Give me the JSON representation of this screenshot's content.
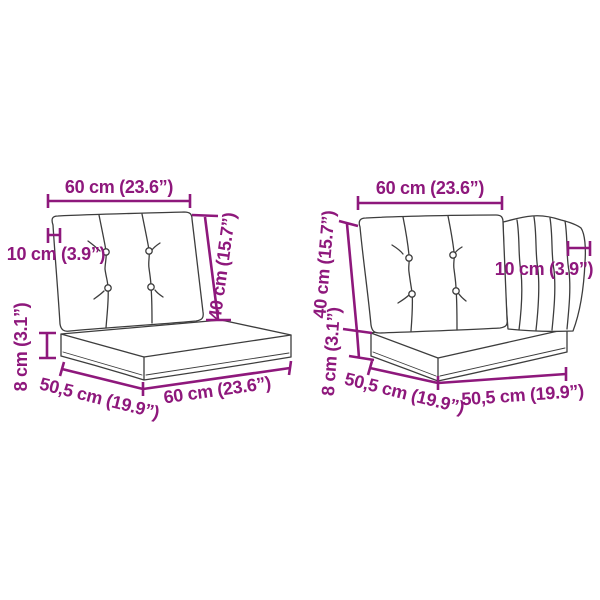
{
  "diagram": {
    "background_color": "#ffffff",
    "dimension_color": "#8E187C",
    "sketch_color": "#3d3d3d",
    "figure_left": {
      "labels": {
        "top_width": "60 cm (23.6”)",
        "back_cushion_thickness": "10 cm (3.9”)",
        "back_cushion_height": "40 cm (15.7”)",
        "seat_cushion_thickness": "8 cm (3.1”)",
        "seat_depth": "50,5 cm (19.9”)",
        "seat_width": "60 cm (23.6”)"
      }
    },
    "figure_right": {
      "labels": {
        "top_width": "60 cm (23.6”)",
        "back_cushion_height": "40 cm (15.7”)",
        "seat_cushion_thickness": "8 cm (3.1”)",
        "back_cushion_thickness": "10 cm (3.9”)",
        "seat_depth_left": "50,5 cm (19.9”)",
        "seat_depth_right": "50,5 cm (19.9”)"
      }
    }
  }
}
